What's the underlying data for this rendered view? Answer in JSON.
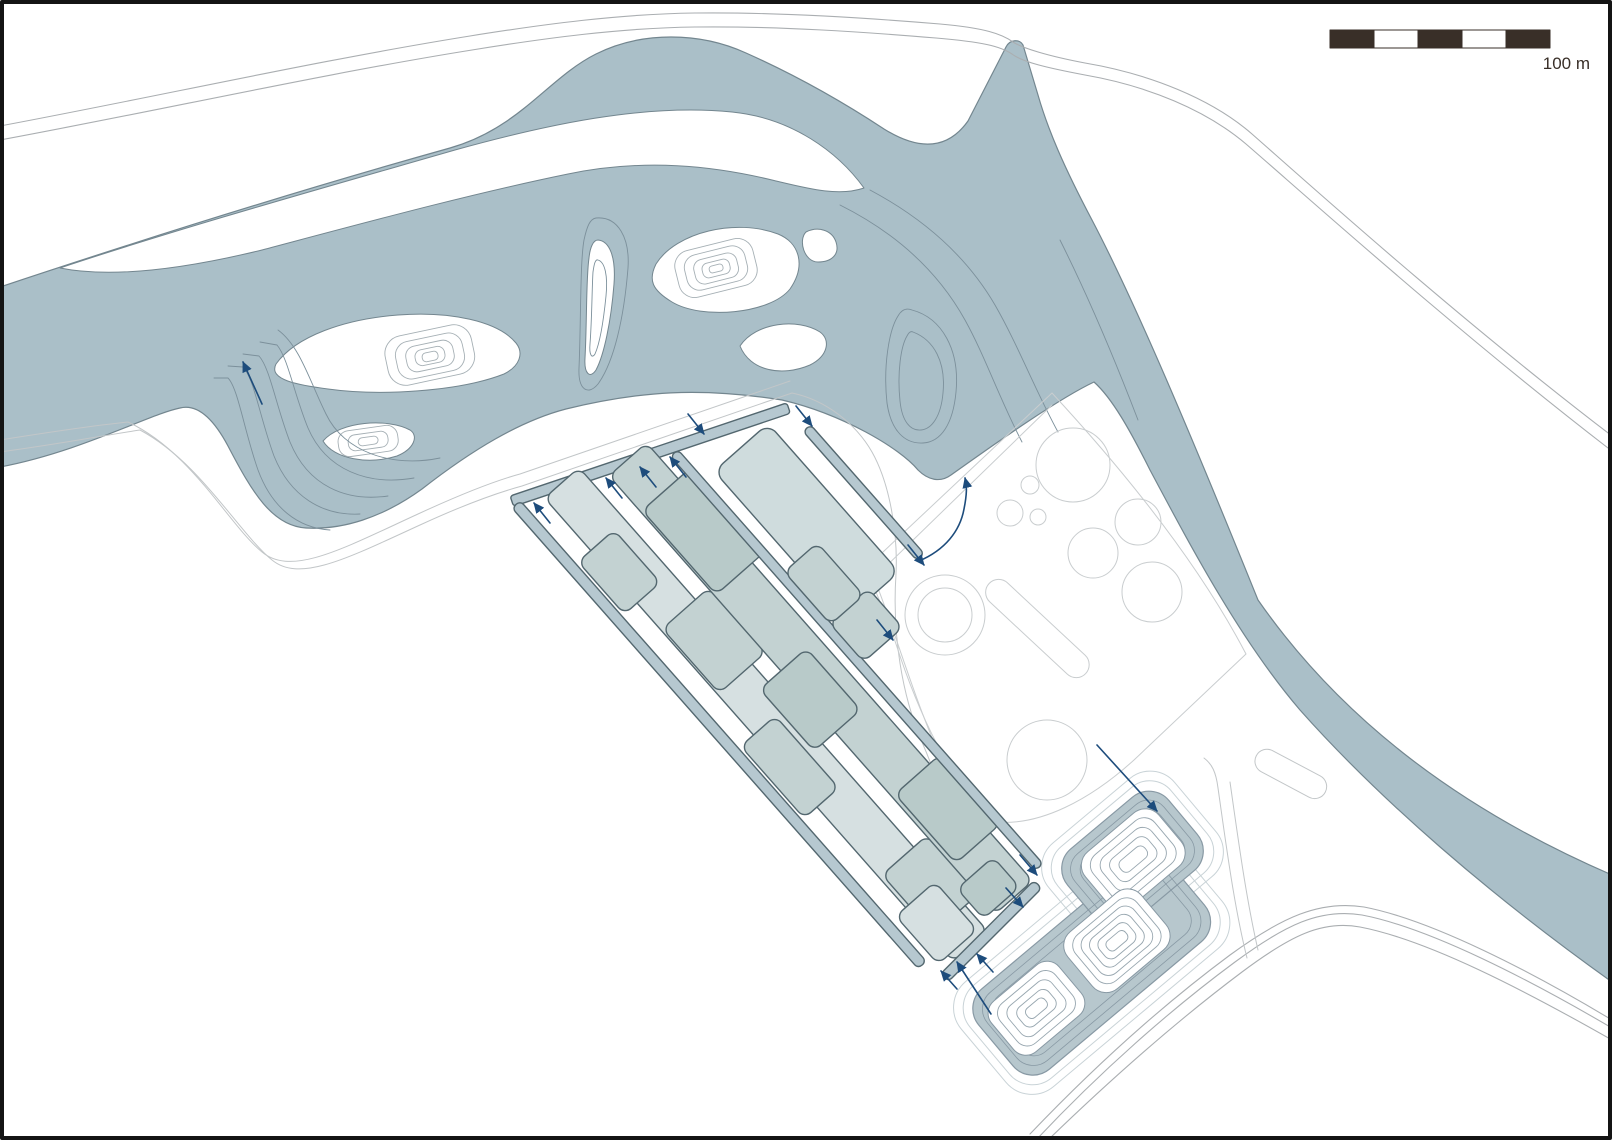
{
  "map": {
    "title": "river-landscape-site-plan",
    "scale_bar": {
      "label": "100 m",
      "segments": 5,
      "segment_pattern": [
        "dark",
        "light",
        "dark",
        "light",
        "dark"
      ]
    },
    "features": {
      "river": "braided river with contour islands",
      "field": "diagonal strip fields with irrigation channels and flow arrows",
      "circles_area": "cleared area with circular features",
      "basin": "terraced retention basin with contour mounds"
    },
    "icons": {
      "flow_arrow": "➤"
    }
  },
  "colors": {
    "water": "#aabfc8",
    "shore": "#73868f",
    "bathy": "#7c909b",
    "hill": "#a6b0b5",
    "road": "#aaaeb1",
    "berm": "#c2c6c8",
    "regionline": "#c9cdcf",
    "striplight": "#d6e0e1",
    "stripmid": "#c3d2d2",
    "stripdark": "#b8cac9",
    "strippale": "#cfdcdd",
    "channel": "#b6c8d0",
    "stripline": "#53676f",
    "arrow": "#1d4c7c",
    "pond": "#b7c7cd",
    "pondline": "#8899a4",
    "moundline": "#97a6af",
    "pondberm": "#c9d3d7",
    "scaledark": "#392f28",
    "frame": "#141414"
  }
}
